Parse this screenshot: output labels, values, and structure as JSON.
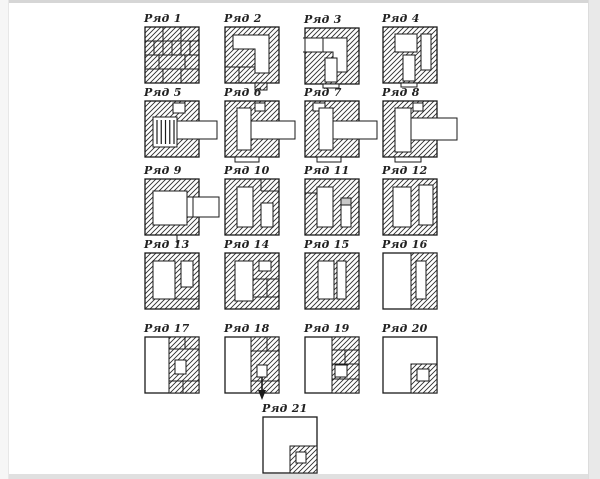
{
  "figure": {
    "kind": "stove-brickwork-course-diagram",
    "rows": [
      {
        "id": 1,
        "label": "Ряд 1"
      },
      {
        "id": 2,
        "label": "Ряд 2"
      },
      {
        "id": 3,
        "label": "Ряд 3"
      },
      {
        "id": 4,
        "label": "Ряд 4"
      },
      {
        "id": 5,
        "label": "Ряд 5"
      },
      {
        "id": 6,
        "label": "Ряд 6"
      },
      {
        "id": 7,
        "label": "Ряд 7"
      },
      {
        "id": 8,
        "label": "Ряд 8"
      },
      {
        "id": 9,
        "label": "Ряд 9"
      },
      {
        "id": 10,
        "label": "Ряд 10"
      },
      {
        "id": 11,
        "label": "Ряд 11"
      },
      {
        "id": 12,
        "label": "Ряд 12"
      },
      {
        "id": 13,
        "label": "Ряд 13"
      },
      {
        "id": 14,
        "label": "Ряд 14"
      },
      {
        "id": 15,
        "label": "Ряд 15"
      },
      {
        "id": 16,
        "label": "Ряд 16"
      },
      {
        "id": 17,
        "label": "Ряд 17"
      },
      {
        "id": 18,
        "label": "Ряд 18"
      },
      {
        "id": 19,
        "label": "Ряд 19"
      },
      {
        "id": 20,
        "label": "Ряд 20"
      },
      {
        "id": 21,
        "label": "Ряд 21"
      }
    ],
    "colors": {
      "line": "#1a1a1a",
      "hatch": "#2e2e2e",
      "background": "#ffffff",
      "frame": "#e0e0e0",
      "damper_gray": "#c8c8c8"
    }
  }
}
